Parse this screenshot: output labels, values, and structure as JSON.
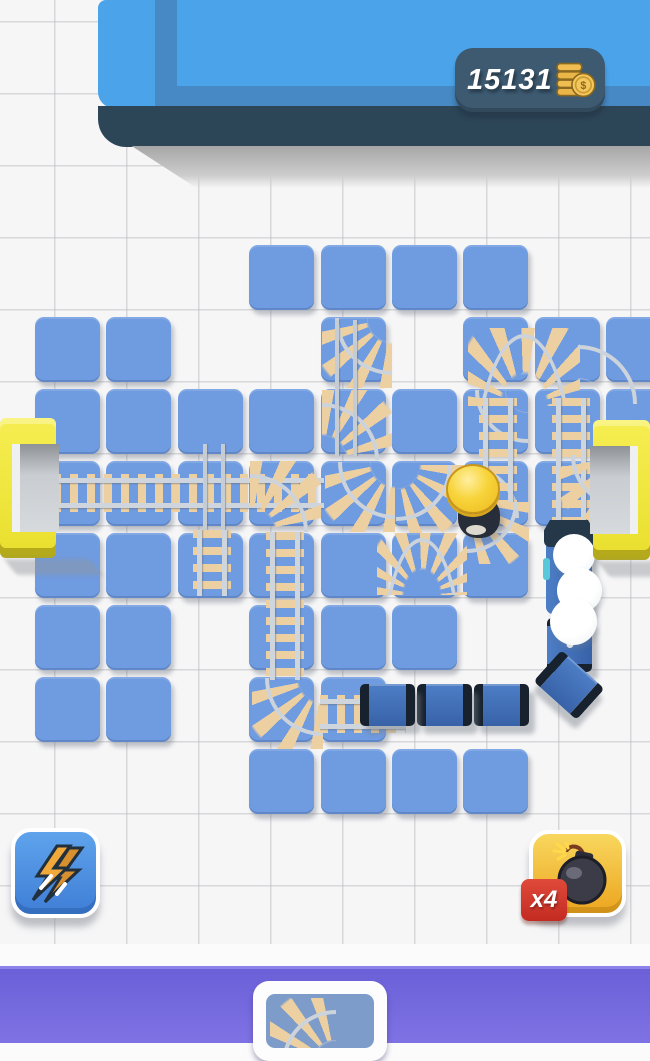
{
  "hud": {
    "coins": "15131",
    "coin_icon": "coin-stack-icon",
    "pill_color": "#3d5a71"
  },
  "powerups": {
    "lightning": {
      "icon": "lightning-icon",
      "button_color": "#4a8fe0"
    },
    "bomb": {
      "icon": "bomb-icon",
      "count_badge": "x4",
      "badge_color": "#d23434",
      "button_color": "#f0b93a"
    }
  },
  "bottom_bar": {
    "card_icon": "curved-track-icon",
    "bar_color": "#6b5fd8"
  },
  "colors": {
    "tile_blue": "#6f9be0",
    "platform_blue": "#4ba4ea",
    "platform_base": "#2d4657",
    "rail_gray": "#cfd5dc",
    "sleeper_tan": "#edd0a2",
    "gate_yellow": "#f1e73a",
    "train_blue": "#3e6cb5",
    "train_dark": "#17222e"
  },
  "board": {
    "grid": {
      "origin_x": 35,
      "origin_y": 245,
      "cell_w": 71.4,
      "cell_h": 72,
      "tile_size": 65
    },
    "tiles": [
      [
        0,
        3
      ],
      [
        0,
        4
      ],
      [
        0,
        5
      ],
      [
        0,
        6
      ],
      [
        1,
        0
      ],
      [
        1,
        1
      ],
      [
        1,
        4
      ],
      [
        1,
        6
      ],
      [
        1,
        7
      ],
      [
        1,
        8
      ],
      [
        2,
        0
      ],
      [
        2,
        1
      ],
      [
        2,
        2
      ],
      [
        2,
        3
      ],
      [
        2,
        4
      ],
      [
        2,
        5
      ],
      [
        2,
        6
      ],
      [
        2,
        7
      ],
      [
        2,
        8
      ],
      [
        3,
        0
      ],
      [
        3,
        1
      ],
      [
        3,
        2
      ],
      [
        3,
        3
      ],
      [
        3,
        4
      ],
      [
        3,
        5
      ],
      [
        3,
        6
      ],
      [
        3,
        7
      ],
      [
        4,
        0
      ],
      [
        4,
        1
      ],
      [
        4,
        2
      ],
      [
        4,
        3
      ],
      [
        4,
        4
      ],
      [
        4,
        5
      ],
      [
        4,
        6
      ],
      [
        5,
        0
      ],
      [
        5,
        1
      ],
      [
        5,
        3
      ],
      [
        5,
        4
      ],
      [
        5,
        5
      ],
      [
        6,
        0
      ],
      [
        6,
        1
      ],
      [
        6,
        3
      ],
      [
        6,
        4
      ],
      [
        7,
        3
      ],
      [
        7,
        4
      ],
      [
        7,
        5
      ],
      [
        7,
        6
      ]
    ],
    "tracks": [
      {
        "type": "track-h",
        "x": 2,
        "y": 470,
        "w": 322,
        "h": 46
      },
      {
        "type": "rail-v",
        "x": 200,
        "y": 444,
        "w": 28,
        "h": 94
      },
      {
        "type": "track-v",
        "x": 189,
        "y": 530,
        "w": 46,
        "h": 66
      },
      {
        "type": "curve-sw",
        "x": 250,
        "y": 461,
        "w": 71,
        "h": 71
      },
      {
        "type": "track-v",
        "x": 262,
        "y": 532,
        "w": 46,
        "h": 148
      },
      {
        "type": "curve-ne",
        "x": 252,
        "y": 678,
        "w": 71,
        "h": 71
      },
      {
        "type": "track-h",
        "x": 320,
        "y": 691,
        "w": 86,
        "h": 46
      },
      {
        "type": "curve-ne",
        "x": 322,
        "y": 318,
        "w": 70,
        "h": 70
      },
      {
        "type": "curve-sw",
        "x": 322,
        "y": 390,
        "w": 70,
        "h": 70
      },
      {
        "type": "rail-v",
        "x": 332,
        "y": 320,
        "w": 28,
        "h": 136
      },
      {
        "type": "curve-ne",
        "x": 325,
        "y": 462,
        "w": 70,
        "h": 70
      },
      {
        "type": "curve-nw",
        "x": 396,
        "y": 465,
        "w": 68,
        "h": 68
      },
      {
        "type": "dome-down",
        "x": 377,
        "y": 533,
        "w": 90,
        "h": 62
      },
      {
        "type": "curve-ne",
        "x": 464,
        "y": 390,
        "w": 64,
        "h": 64,
        "bare": true
      },
      {
        "type": "curve-sw",
        "x": 466,
        "y": 454,
        "w": 64,
        "h": 64,
        "bare": true
      },
      {
        "type": "dome-down",
        "x": 468,
        "y": 328,
        "w": 112,
        "h": 78
      },
      {
        "type": "track-v",
        "x": 475,
        "y": 398,
        "w": 46,
        "h": 110
      },
      {
        "type": "track-v",
        "x": 548,
        "y": 398,
        "w": 46,
        "h": 126
      },
      {
        "type": "curve-nw",
        "x": 467,
        "y": 502,
        "w": 62,
        "h": 62
      },
      {
        "type": "curve-sw",
        "x": 578,
        "y": 332,
        "w": 72,
        "h": 72,
        "bare": true
      },
      {
        "type": "curve-ne",
        "x": 560,
        "y": 455,
        "w": 64,
        "h": 64
      },
      {
        "type": "track-h",
        "x": 598,
        "y": 467,
        "w": 34,
        "h": 44
      }
    ],
    "train": {
      "wagons": [
        {
          "kind": "engine",
          "x": 546,
          "y": 522,
          "w": 46,
          "h": 92,
          "angle": 0
        },
        {
          "kind": "wagon-v",
          "x": 547,
          "y": 618,
          "w": 45,
          "h": 54,
          "angle": 0
        },
        {
          "kind": "wagon",
          "x": 540,
          "y": 664,
          "w": 58,
          "h": 42,
          "angle": 42
        },
        {
          "kind": "wagon",
          "x": 474,
          "y": 684,
          "w": 55,
          "h": 42,
          "angle": 0
        },
        {
          "kind": "wagon",
          "x": 417,
          "y": 684,
          "w": 55,
          "h": 42,
          "angle": 0
        },
        {
          "kind": "wagon",
          "x": 360,
          "y": 684,
          "w": 55,
          "h": 42,
          "angle": 0
        }
      ],
      "smoke": [
        {
          "x": 553,
          "y": 534,
          "d": 42
        },
        {
          "x": 557,
          "y": 568,
          "d": 45
        },
        {
          "x": 550,
          "y": 598,
          "d": 47
        }
      ]
    }
  }
}
